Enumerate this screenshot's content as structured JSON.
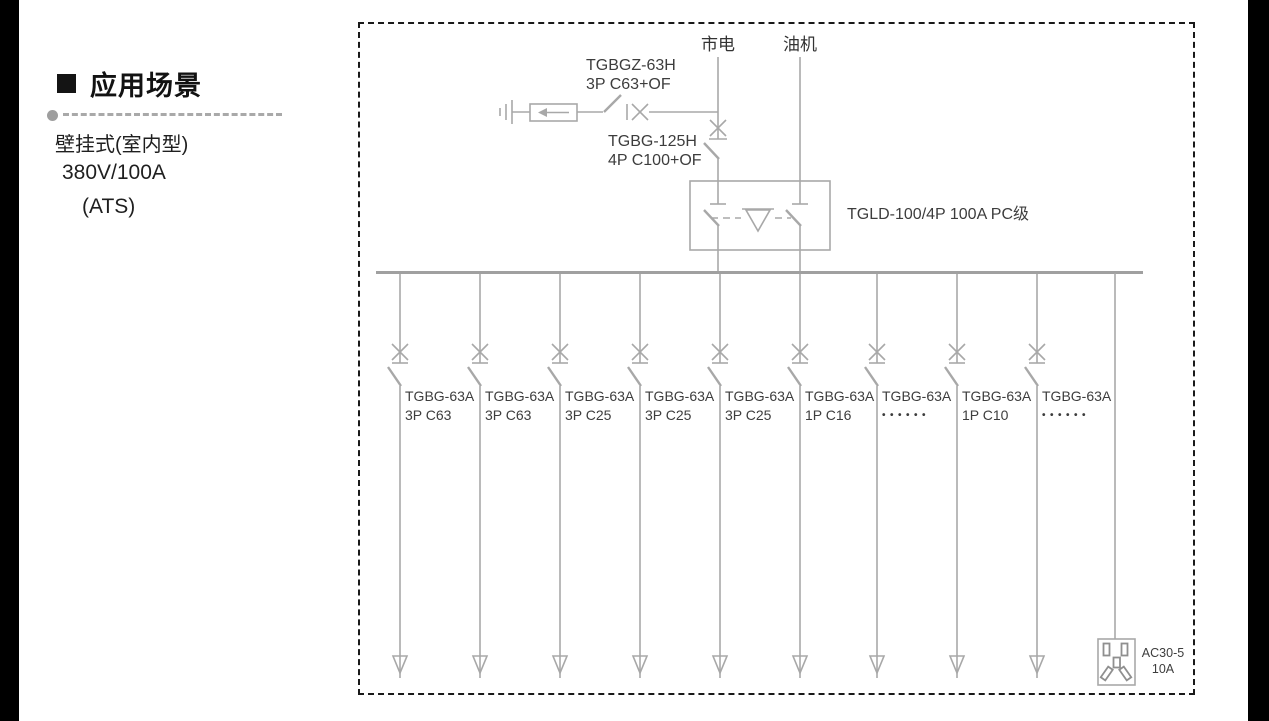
{
  "sidebar": {
    "heading": "应用场景",
    "subtitle_lines": [
      "壁挂式(室内型)",
      "380V/100A",
      "(ATS)"
    ]
  },
  "diagram": {
    "source_mains_label": "市电",
    "source_generator_label": "油机",
    "spd_branch_breaker": {
      "model": "TGBGZ-63H",
      "spec": "3P C63+OF"
    },
    "main_breaker": {
      "model": "TGBG-125H",
      "spec": "4P C100+OF"
    },
    "ats_label": "TGLD-100/4P 100A PC级",
    "branches": [
      {
        "model": "TGBG-63A",
        "spec": "3P C63"
      },
      {
        "model": "TGBG-63A",
        "spec": "3P C63"
      },
      {
        "model": "TGBG-63A",
        "spec": "3P C25"
      },
      {
        "model": "TGBG-63A",
        "spec": "3P C25"
      },
      {
        "model": "TGBG-63A",
        "spec": "3P C25"
      },
      {
        "model": "TGBG-63A",
        "spec": "1P C16"
      },
      {
        "model": "TGBG-63A",
        "spec": "••••••"
      },
      {
        "model": "TGBG-63A",
        "spec": "1P C10"
      },
      {
        "model": "TGBG-63A",
        "spec": "••••••"
      }
    ],
    "socket": {
      "model": "AC30-5",
      "rating": "10A"
    },
    "colors": {
      "line_gray": "#a8a8a8",
      "text_gray": "#3d3d3d",
      "frame_black": "#191919"
    }
  }
}
